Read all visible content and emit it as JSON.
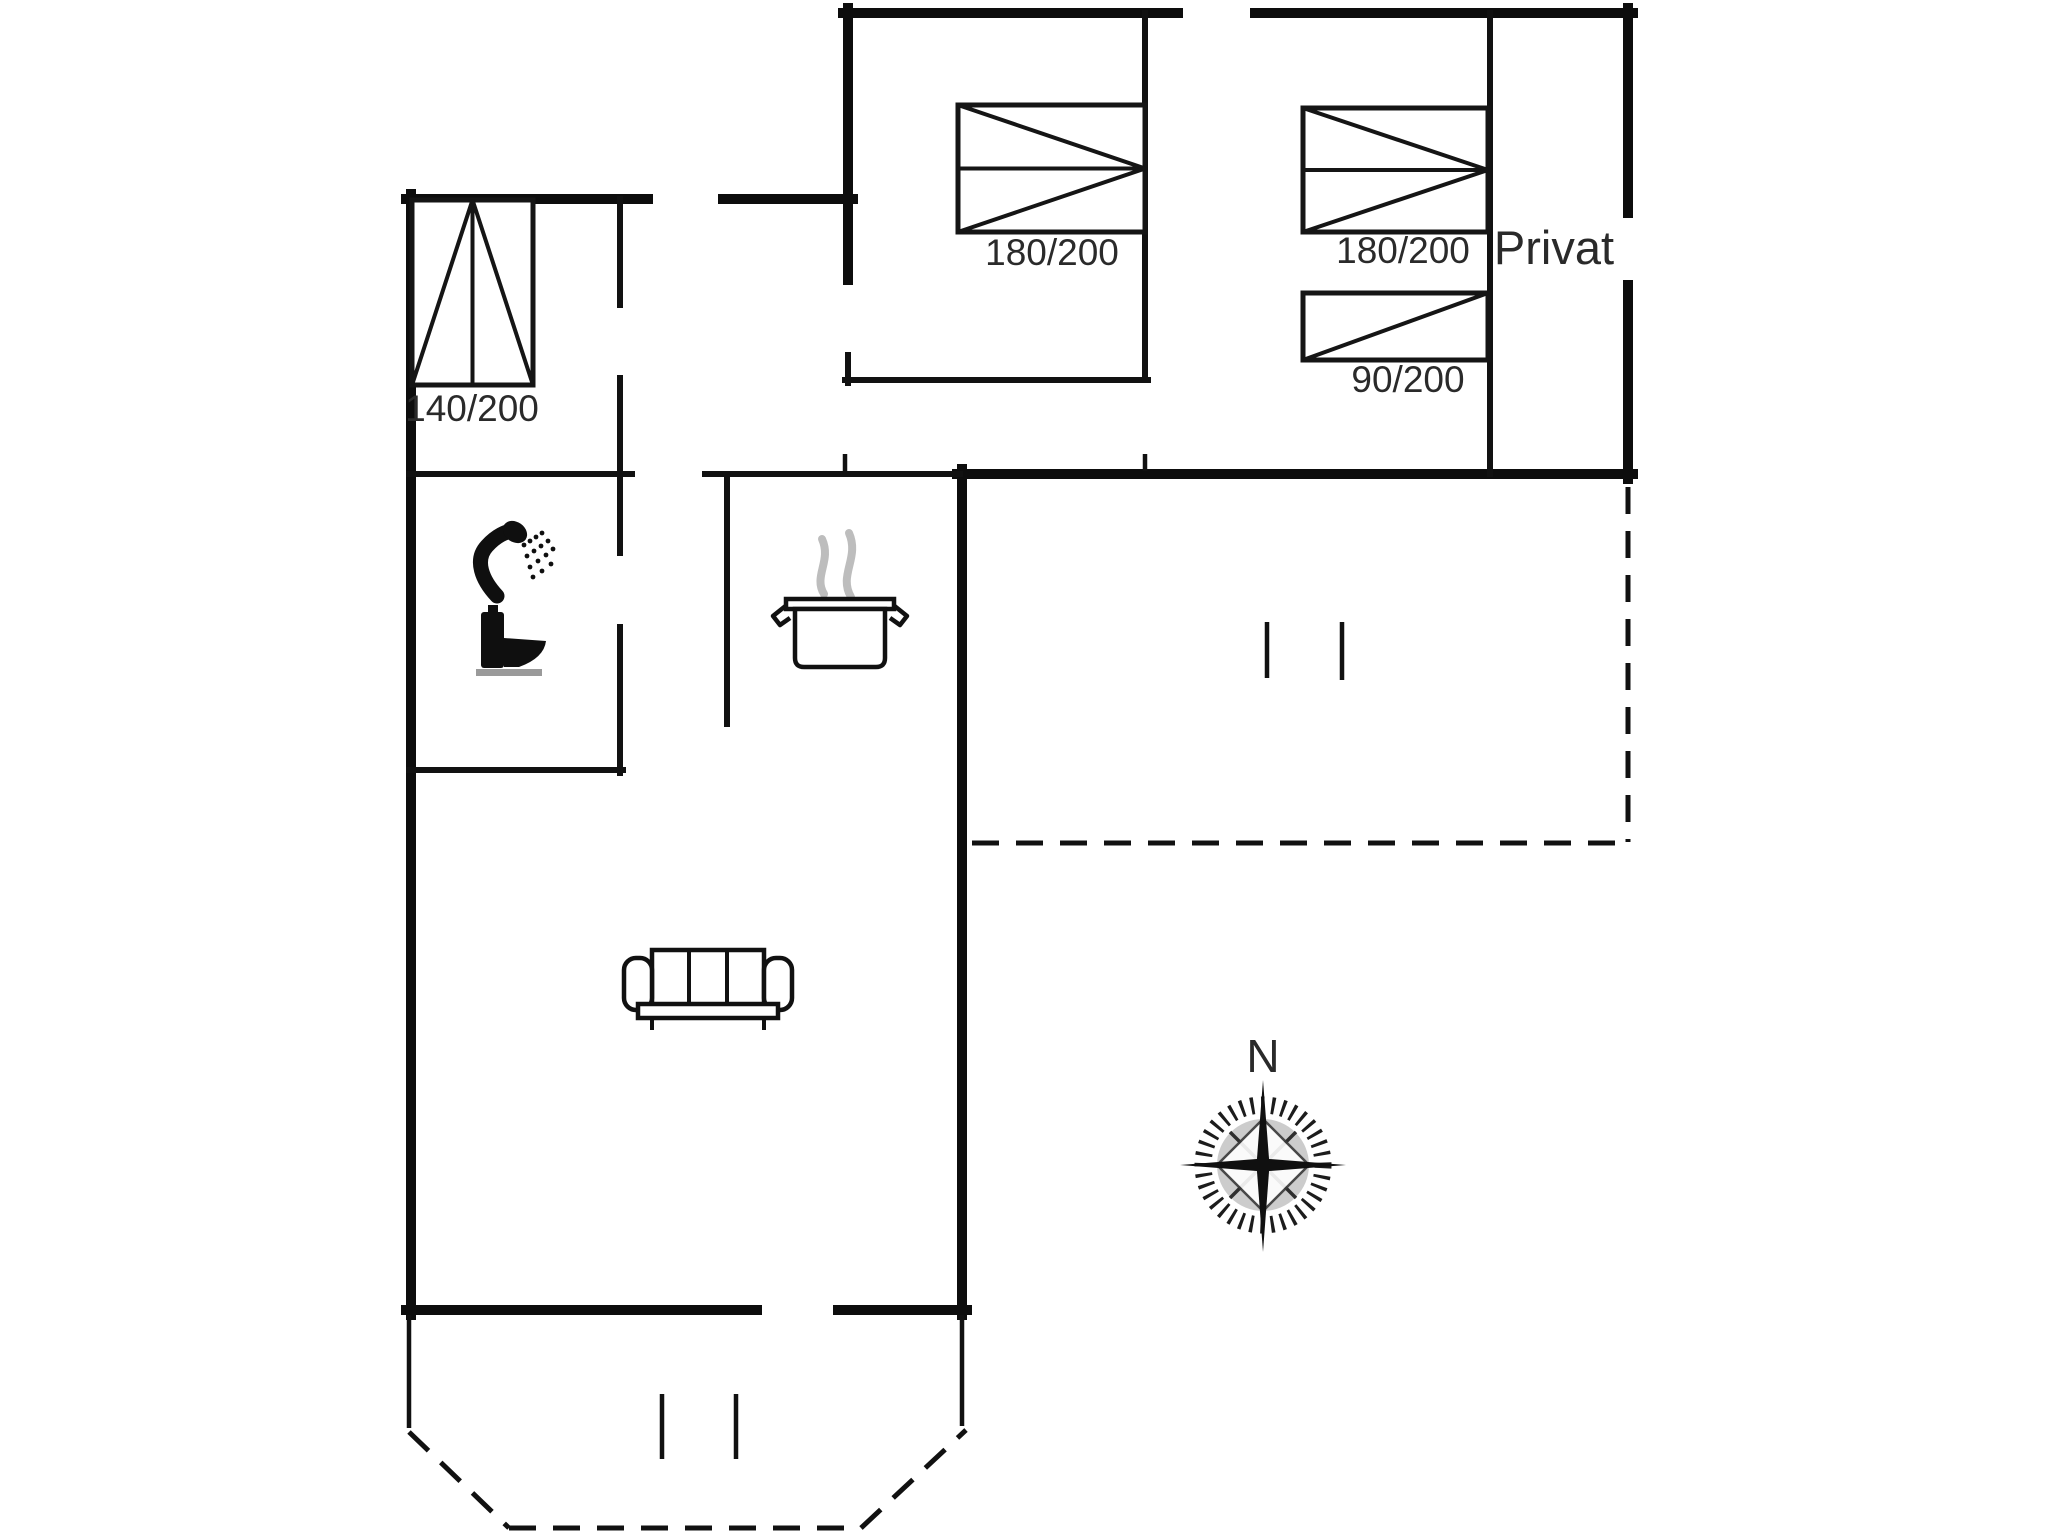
{
  "document": {
    "type": "holiday-house-floor-plan",
    "background_color": "#ffffff",
    "ink_color": "#111111",
    "muted_color": "#bdbdbd"
  },
  "labels": [
    {
      "name": "bed-size-140-200",
      "text": "140/200",
      "x": 472,
      "y": 421,
      "size": 37
    },
    {
      "name": "bed-size-180-200-middle-room",
      "text": "180/200",
      "x": 1052,
      "y": 265,
      "size": 37
    },
    {
      "name": "bed-size-180-200-private-room",
      "text": "180/200",
      "x": 1403,
      "y": 263,
      "size": 37
    },
    {
      "name": "bed-size-90-200",
      "text": "90/200",
      "x": 1408,
      "y": 392,
      "size": 37
    },
    {
      "name": "private-room-label",
      "text": "Privat",
      "x": 1554,
      "y": 264,
      "size": 47
    },
    {
      "name": "compass-north-label",
      "text": "N",
      "x": 1263,
      "y": 1072,
      "size": 46
    }
  ],
  "icons": [
    "shower-icon",
    "toilet-icon",
    "cooking-pot-icon",
    "steam-icon",
    "sofa-icon",
    "compass-rose-icon",
    "bed-icon"
  ],
  "plan": {
    "canvas": {
      "width": 2048,
      "height": 1536
    },
    "walls_thick": [
      [
        411,
        194,
        411,
        1315
      ],
      [
        406,
        199,
        648,
        199
      ],
      [
        723,
        199,
        853,
        199
      ],
      [
        848,
        8,
        848,
        280
      ],
      [
        843,
        13,
        1178,
        13
      ],
      [
        1255,
        13,
        1633,
        13
      ],
      [
        1628,
        8,
        1628,
        213
      ],
      [
        1628,
        285,
        1628,
        479
      ],
      [
        957,
        474,
        1633,
        474
      ],
      [
        962,
        469,
        962,
        1315
      ],
      [
        406,
        1310,
        757,
        1310
      ],
      [
        838,
        1310,
        967,
        1310
      ]
    ],
    "walls_medium": [
      [
        409,
        474,
        632,
        474
      ],
      [
        705,
        474,
        960,
        474
      ],
      [
        620,
        199,
        620,
        305
      ],
      [
        620,
        378,
        620,
        553
      ],
      [
        620,
        627,
        620,
        773
      ],
      [
        409,
        770,
        623,
        770
      ],
      [
        727,
        474,
        727,
        724
      ],
      [
        848,
        355,
        848,
        383
      ],
      [
        845,
        380,
        1148,
        380
      ],
      [
        1145,
        13,
        1145,
        376
      ],
      [
        1490,
        13,
        1490,
        474
      ]
    ],
    "walls_thin": [
      [
        845,
        454,
        845,
        471
      ],
      [
        1145,
        454,
        1145,
        471
      ],
      [
        409,
        1315,
        409,
        1428
      ],
      [
        962,
        1315,
        962,
        1426
      ],
      [
        1267,
        622,
        1267,
        678
      ],
      [
        1342,
        622,
        1342,
        680
      ],
      [
        662,
        1394,
        662,
        1459
      ],
      [
        736,
        1394,
        736,
        1459
      ]
    ],
    "walls_dashed": [
      [
        1628,
        487,
        1628,
        842
      ],
      [
        972,
        843,
        1628,
        843
      ],
      [
        409,
        1432,
        509,
        1528
      ],
      [
        509,
        1528,
        861,
        1528
      ],
      [
        861,
        1528,
        966,
        1430
      ]
    ],
    "beds": [
      {
        "name": "bed-140x200",
        "size": "140/200",
        "rect": [
          412,
          200,
          121,
          185
        ],
        "pattern": "single-apex"
      },
      {
        "name": "bed-180x200-middle-room",
        "size": "180/200",
        "rect": [
          958,
          105,
          187,
          127
        ],
        "pattern": "double"
      },
      {
        "name": "bed-180x200-private-room",
        "size": "180/200",
        "rect": [
          1303,
          108,
          185,
          124
        ],
        "pattern": "double"
      },
      {
        "name": "bed-90x200",
        "size": "90/200",
        "rect": [
          1303,
          293,
          185,
          67
        ],
        "pattern": "single-diag"
      }
    ]
  }
}
